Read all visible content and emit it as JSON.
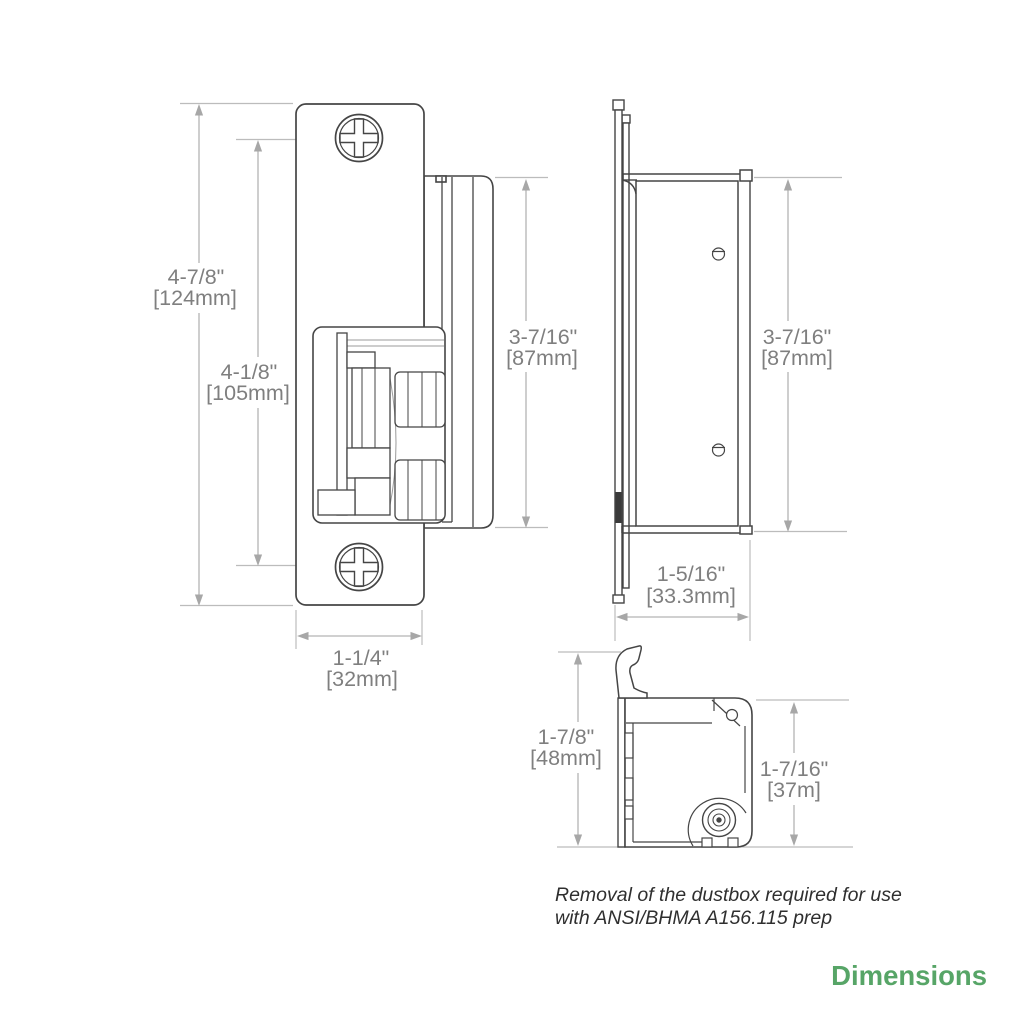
{
  "page": {
    "title_label": "Dimensions",
    "accent_color": "#57a567"
  },
  "note": {
    "line1": "Removal of the dustbox required for use",
    "line2": "with ANSI/BHMA A156.115 prep"
  },
  "front_view": {
    "overall_height": {
      "in": "4-7/8\"",
      "mm": "[124mm]"
    },
    "screw_spacing": {
      "in": "4-1/8\"",
      "mm": "[105mm]"
    },
    "body_height": {
      "in": "3-7/16\"",
      "mm": "[87mm]"
    },
    "faceplate_width": {
      "in": "1-1/4\"",
      "mm": "[32mm]"
    }
  },
  "side_view": {
    "body_height": {
      "in": "3-7/16\"",
      "mm": "[87mm]"
    },
    "depth": {
      "in": "1-5/16\"",
      "mm": "[33.3mm]"
    }
  },
  "bottom_view": {
    "overall_depth": {
      "in": "1-7/8\"",
      "mm": "[48mm]"
    },
    "body_depth": {
      "in": "1-7/16\"",
      "mm": "[37m]"
    }
  }
}
